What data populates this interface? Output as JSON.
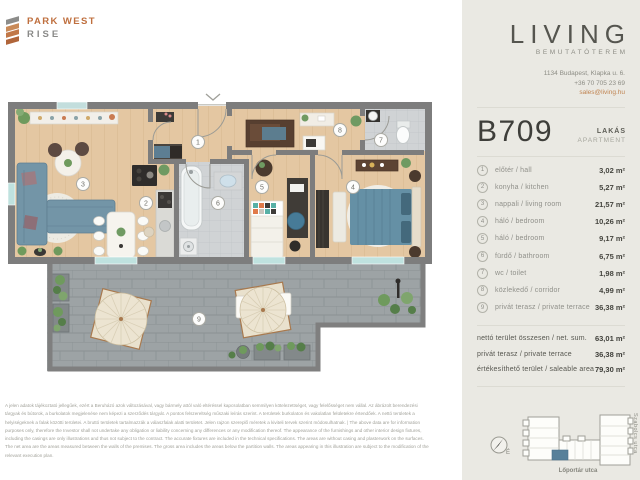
{
  "brand": {
    "name_top": "PARK WEST",
    "name_bottom": "RISE"
  },
  "showroom": {
    "name": "LIVING",
    "subtitle": "BEMUTATÓTEREM",
    "address": "1134 Budapest, Klapka u. 6.",
    "phone": "+36 70 705 23 69",
    "email": "sales@living.hu"
  },
  "unit": {
    "code": "B709",
    "type_hu": "LAKÁS",
    "type_en": "APARTMENT"
  },
  "rooms": [
    {
      "num": "1",
      "name": "előtér  /  hall",
      "area": "3,02 m²"
    },
    {
      "num": "2",
      "name": "konyha  /  kitchen",
      "area": "5,27 m²"
    },
    {
      "num": "3",
      "name": "nappali  /  living room",
      "area": "21,57 m²"
    },
    {
      "num": "4",
      "name": "háló  /  bedroom",
      "area": "10,26 m²"
    },
    {
      "num": "5",
      "name": "háló  /  bedroom",
      "area": "9,17 m²"
    },
    {
      "num": "6",
      "name": "fürdő  /  bathroom",
      "area": "6,75 m²"
    },
    {
      "num": "7",
      "name": "wc  /  toilet",
      "area": "1,98 m²"
    },
    {
      "num": "8",
      "name": "közlekedő  /  corridor",
      "area": "4,99 m²"
    },
    {
      "num": "9",
      "name": "privát terasz  /  private terrace",
      "area": "36,38 m²"
    }
  ],
  "totals": [
    {
      "label": "nettó terület összesen / net. sum.",
      "value": "63,01 m²"
    },
    {
      "label": "privát terasz  /  private terrace",
      "value": "36,38 m²"
    },
    {
      "label": "értékesíthető terület  /  saleable area",
      "value": "79,30 m²"
    }
  ],
  "site_map": {
    "street_right": "Szabolcs utca",
    "street_bottom": "Lőportár utca",
    "compass": "É",
    "highlight_color": "#57809a"
  },
  "disclaimer_lines": [
    "A jelen adatok tájékoztató jellegűek, ezért a Beruházó azok változásával, vagy bármely attól való eltéréssel kapcsolatban semmilyen kötelezettséget, vagy felelősséget nem vállal. Az ábrázolt berendezési",
    "tárgyak és bútorok, a burkolatok megjelenése nem képezi a szerződés tárgyát. A pontos felszereltség műszaki leírás szerint. A területek burkolaton és vakolatlan felületekre értendőek. A nettó területek a",
    "helyiségeknek a falak közötti területei. A bruttó területek tartalmazzák a válaszfalak alatti területet. Jelen rajzon szereplő méretek a kiviteli tervek szerint módosulhatnak. | The above data are for information",
    "purposes only, therefore the Investor shall not undertake any obligation or liability concerning any differences or any modification thereof. The appearance of the furnishings and other interior design fixtures,",
    "including the casings are only illustrations and thus not subject to the contract. The accurate fixtures are included in the technical specifications. The areas are without casing and plasterwork on the surfaces.",
    "The net area are the areas measured between the walls of the premises. The gross area includes the areas below the partition walls. The areas appearing in this illustration are subject to the modification of the",
    "relevant execution plan."
  ]
}
